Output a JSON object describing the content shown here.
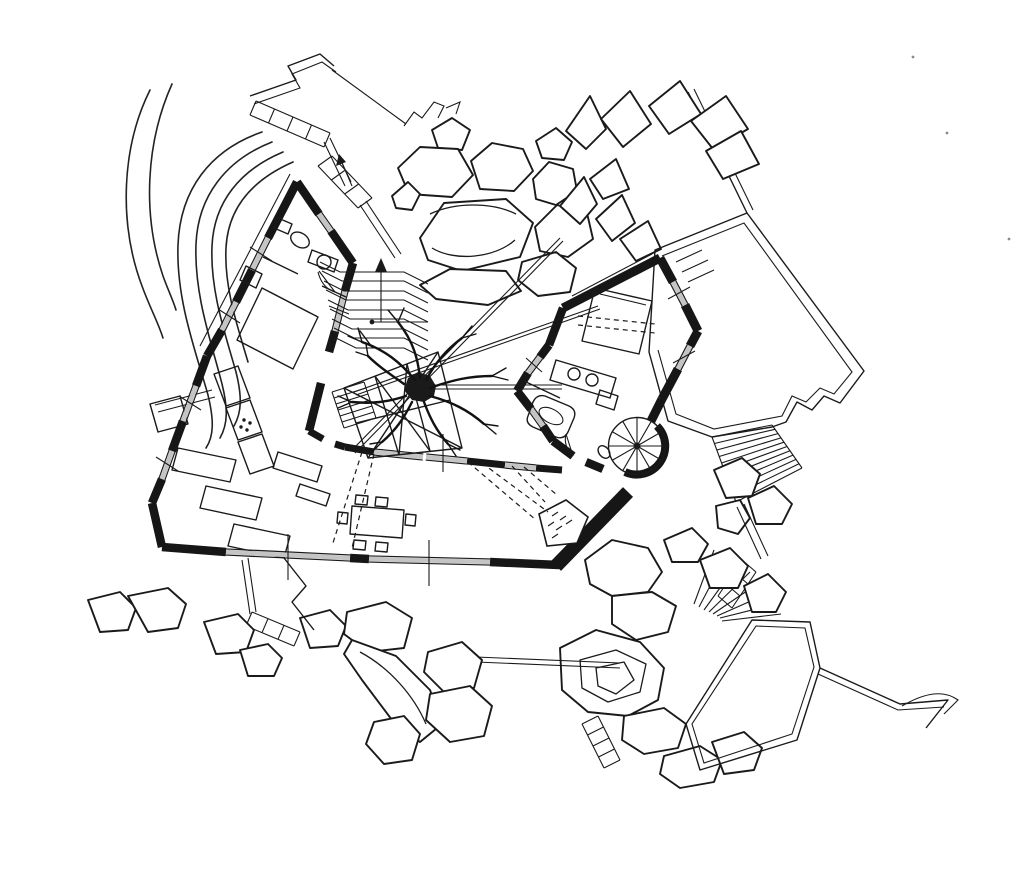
{
  "canvas": {
    "width": 1024,
    "height": 876,
    "paper": "#ffffff",
    "ink": "#1a1a1a",
    "glazing": "#c4c4c4"
  },
  "drawing": {
    "type": "hand-drafted ink architectural site and floor plan",
    "features": [
      "hexagonal-house-plan",
      "central-courtyard-tree",
      "terraced-courtyard-steps",
      "spiral-staircase",
      "corner-fireplace",
      "kitchen-counters",
      "beds",
      "bathtub",
      "dining-table-with-chairs",
      "boulder-clusters",
      "timber-deck-with-wide-stair",
      "site-paths-with-steps",
      "topographic-contours",
      "planter-terraces",
      "lower-stone-terrace"
    ]
  }
}
